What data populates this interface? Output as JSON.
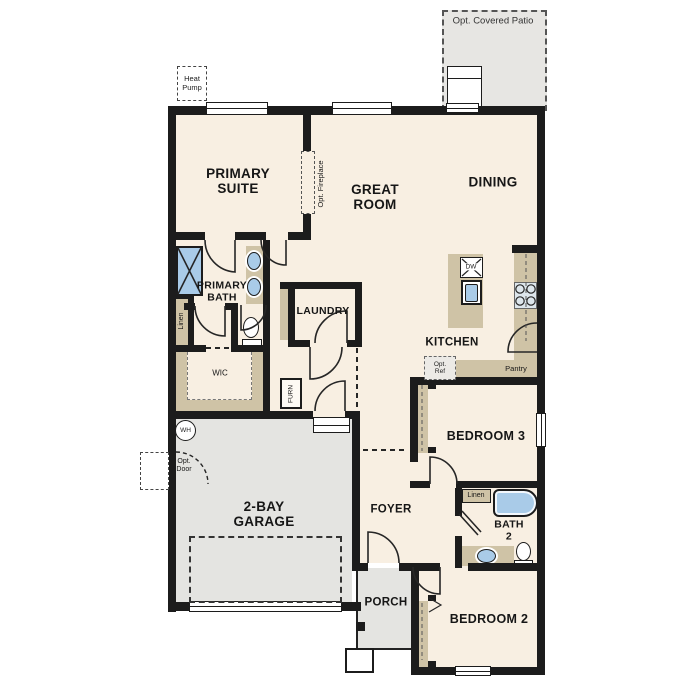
{
  "plan": {
    "title": "Single-story home floor plan",
    "colors": {
      "floor": "#f8efe2",
      "concrete": "#e4e4e1",
      "cabinet": "#cfc3a6",
      "fixture": "#a9cbe8",
      "stove": "#dde6ec",
      "wall": "#1c1c1c"
    },
    "labels": {
      "opt_covered_patio": "Opt. Covered Patio",
      "heat_pump": "Heat\nPump",
      "primary_suite": "PRIMARY\nSUITE",
      "opt_fireplace": "Opt. Fireplace",
      "great_room": "GREAT\nROOM",
      "dining": "DINING",
      "primary_bath": "PRIMARY\nBATH",
      "linen_primary": "Linen",
      "laundry": "LAUNDRY",
      "dishwasher": "DW",
      "kitchen": "KITCHEN",
      "opt_ref": "Opt.\nRef",
      "pantry": "Pantry",
      "wic": "WIC",
      "furnace": "FURN",
      "bedroom_3": "BEDROOM 3",
      "water_heater": "WH",
      "opt_door": "Opt.\nDoor",
      "garage": "2-BAY\nGARAGE",
      "foyer": "FOYER",
      "linen_bath2": "Linen",
      "bath_2": "BATH\n2",
      "porch": "PORCH",
      "bedroom_2": "BEDROOM 2"
    }
  }
}
